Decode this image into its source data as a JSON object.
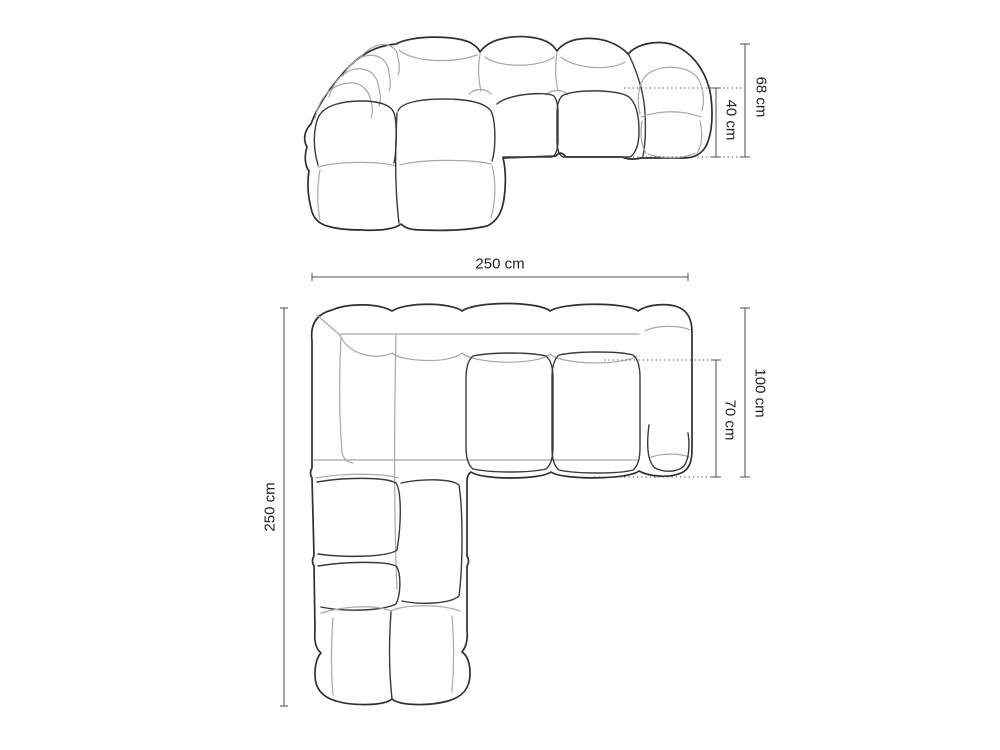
{
  "colors": {
    "background": "#ffffff",
    "outline": "#303030",
    "inner_line": "#a8a8a8",
    "dimension_line": "#4d4d4d",
    "label_text": "#1f1f1f"
  },
  "dimensions": {
    "front": {
      "total_height": "68 cm",
      "seat_height": "40 cm"
    },
    "plan": {
      "width": "250 cm",
      "depth": "250 cm",
      "right_depth": "100 cm",
      "seat_depth": "70 cm"
    }
  }
}
